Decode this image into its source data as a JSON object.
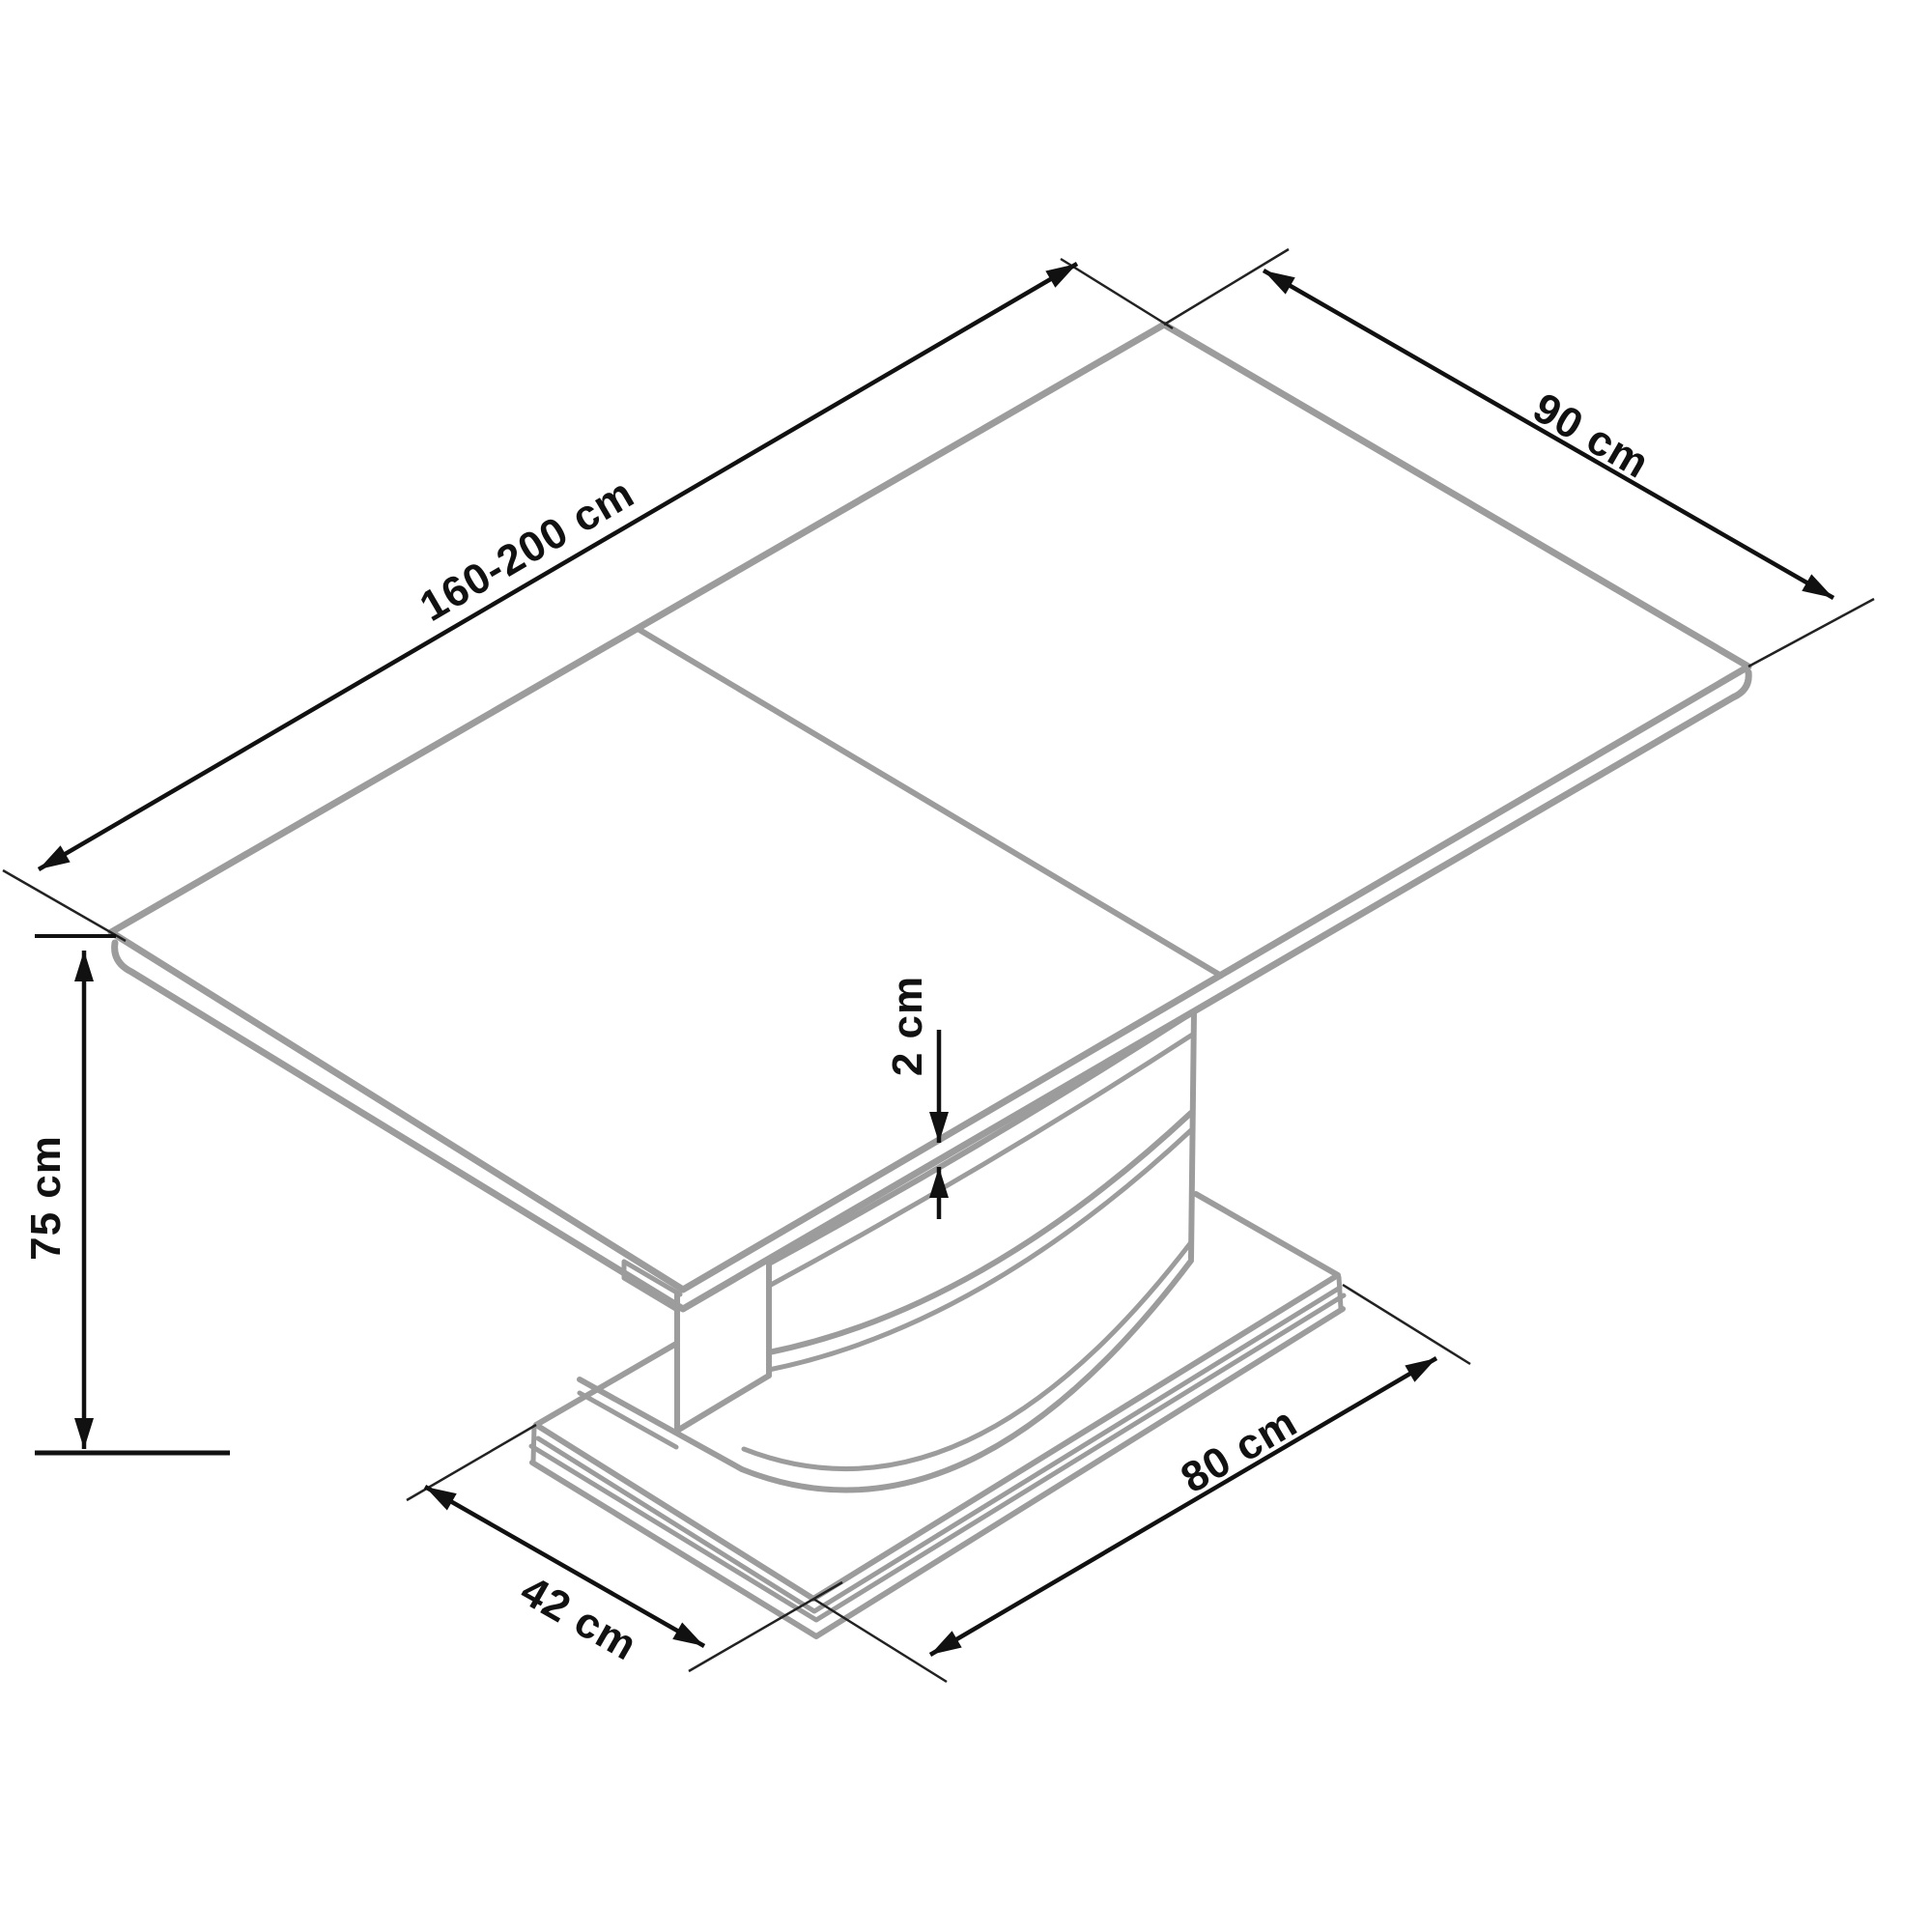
{
  "diagram": {
    "type": "furniture-dimension-drawing",
    "subject": "Extendable pedestal dining table - isometric line drawing with dimensions",
    "unit": "cm",
    "dimensions": {
      "length": {
        "label": "160-200 cm",
        "min": 160,
        "max": 200,
        "measures": "table top length (extendable)"
      },
      "width": {
        "label": "90 cm",
        "value": 90,
        "measures": "table top width"
      },
      "height": {
        "label": "75 cm",
        "value": 75,
        "measures": "overall table height"
      },
      "top_thickness": {
        "label": "2 cm",
        "value": 2,
        "measures": "table top thickness"
      },
      "base_depth": {
        "label": "42 cm",
        "value": 42,
        "measures": "pedestal base depth"
      },
      "base_width": {
        "label": "80 cm",
        "value": 80,
        "measures": "pedestal base width"
      }
    },
    "colors": {
      "outline_gray": "#9c9c9c",
      "dimension_black": "#111111",
      "background": "#ffffff"
    }
  }
}
